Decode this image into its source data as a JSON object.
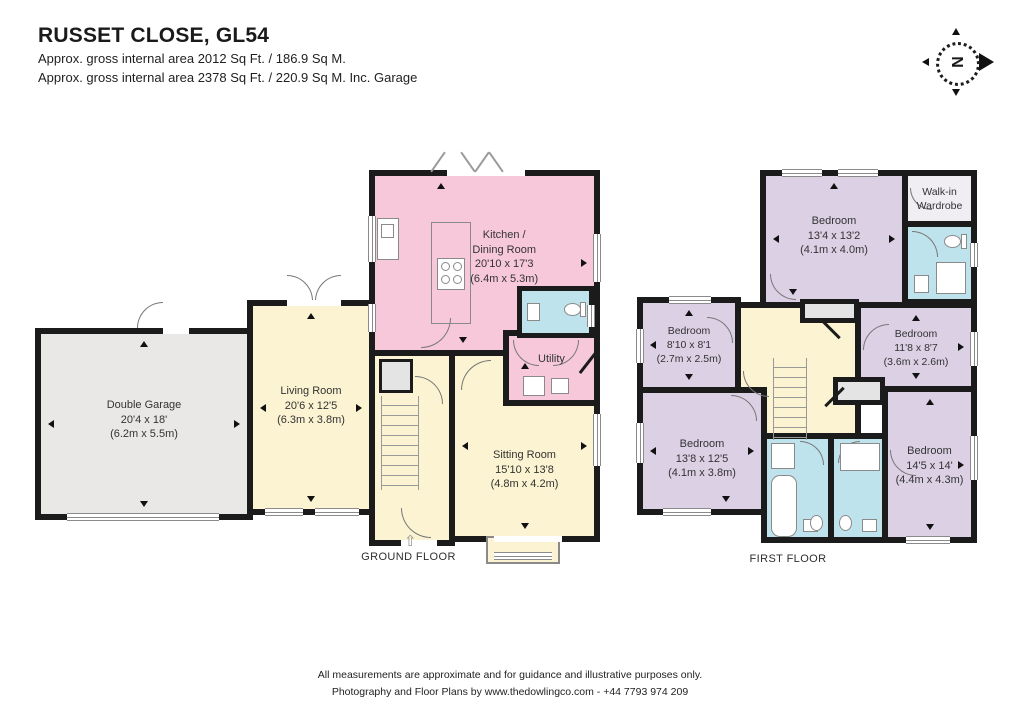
{
  "header": {
    "title": "RUSSET CLOSE, GL54",
    "subtitle1": "Approx. gross internal area 2012 Sq Ft. / 186.9 Sq M.",
    "subtitle2": "Approx. gross internal area 2378 Sq Ft. / 220.9 Sq M. Inc. Garage"
  },
  "compass": {
    "north_label": "N"
  },
  "ground_floor": {
    "label": "GROUND FLOOR",
    "entrance_icon": "⇧",
    "rooms": {
      "garage": {
        "name": "Double Garage",
        "size_ft": "20'4 x 18'",
        "size_m": "(6.2m x 5.5m)"
      },
      "living": {
        "name": "Living Room",
        "size_ft": "20'6 x 12'5",
        "size_m": "(6.3m x 3.8m)"
      },
      "kitchen": {
        "name_line1": "Kitchen /",
        "name_line2": "Dining Room",
        "size_ft": "20'10 x 17'3",
        "size_m": "(6.4m x 5.3m)"
      },
      "utility": {
        "name": "Utility"
      },
      "sitting": {
        "name": "Sitting Room",
        "size_ft": "15'10 x 13'8",
        "size_m": "(4.8m x 4.2m)"
      }
    }
  },
  "first_floor": {
    "label": "FIRST FLOOR",
    "rooms": {
      "bedroom_1": {
        "name": "Bedroom",
        "size_ft": "13'4 x 13'2",
        "size_m": "(4.1m x 4.0m)"
      },
      "walk_in_wardrobe": {
        "name_line1": "Walk-in",
        "name_line2": "Wardrobe"
      },
      "bedroom_2": {
        "name": "Bedroom",
        "size_ft": "8'10 x 8'1",
        "size_m": "(2.7m x 2.5m)"
      },
      "bedroom_3": {
        "name": "Bedroom",
        "size_ft": "11'8 x 8'7",
        "size_m": "(3.6m x 2.6m)"
      },
      "bedroom_4": {
        "name": "Bedroom",
        "size_ft": "13'8 x 12'5",
        "size_m": "(4.1m x 3.8m)"
      },
      "bedroom_5": {
        "name": "Bedroom",
        "size_ft": "14'5 x 14'",
        "size_m": "(4.4m x 4.3m)"
      }
    }
  },
  "footer": {
    "line1": "All measurements are approximate and for guidance and illustrative purposes only.",
    "line2": "Photography and Floor Plans by www.thedowlingco.com - +44 7793 974 209"
  },
  "colors": {
    "wall": "#1b1b1b",
    "garage_fill": "#e9e8e7",
    "reception_fill": "#fbf3d1",
    "kitchen_fill": "#f6c8da",
    "bedroom_fill": "#dcd0e5",
    "bathroom_fill": "#bfe3ed",
    "wardrobe_fill": "#f0edf3"
  }
}
